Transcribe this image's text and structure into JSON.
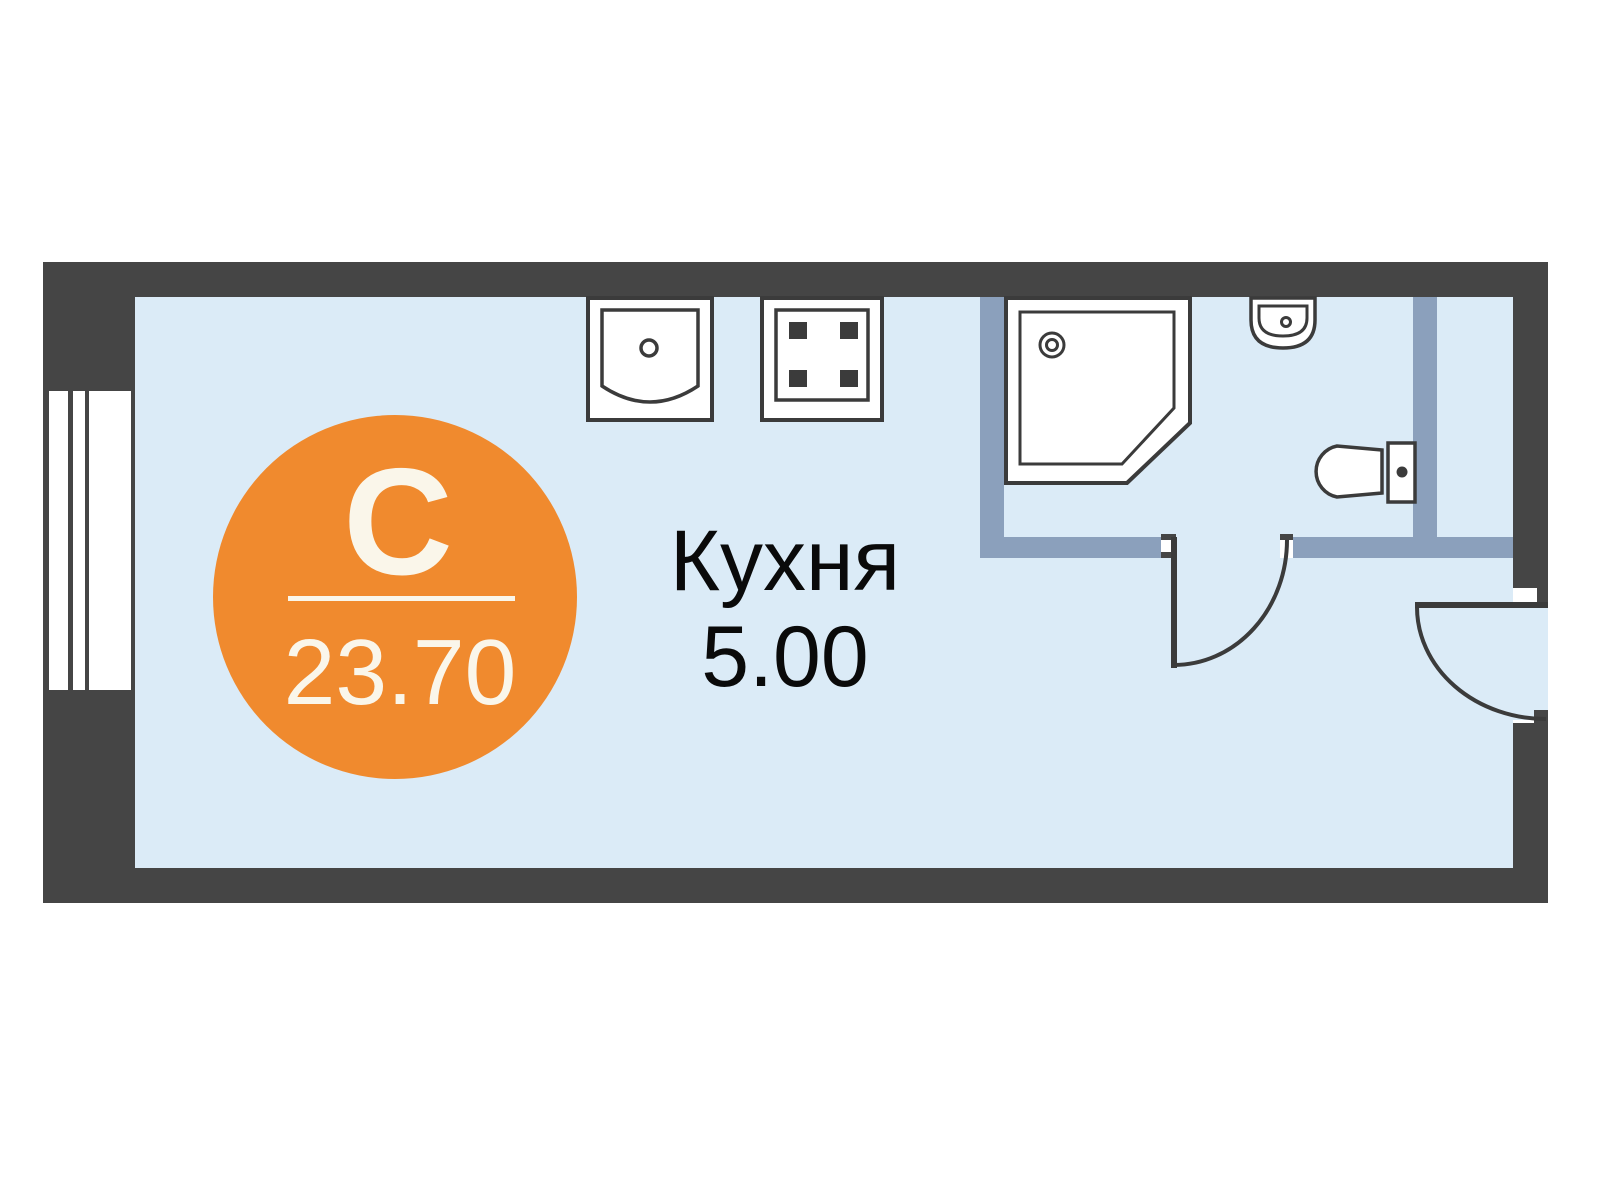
{
  "plan": {
    "room_label": {
      "name": "Кухня",
      "area": "5.00"
    },
    "unit_badge": {
      "type_letter": "С",
      "area": "23.70"
    },
    "fixtures": [
      "window",
      "kitchen-sink",
      "stove",
      "shower-cabin",
      "washbasin",
      "toilet",
      "bathroom-door",
      "entrance-door"
    ],
    "colors": {
      "wall_dark": "#454545",
      "wall_partition": "#8BA0BC",
      "floor": "#DBEBF7",
      "fixture_outline": "#3B3B3B",
      "fixture_fill": "#FFFFFF",
      "badge_orange": "#F08A2E",
      "badge_text": "#FAF6EA",
      "label_text": "#0A0A0A",
      "background": "#FFFFFF"
    }
  }
}
